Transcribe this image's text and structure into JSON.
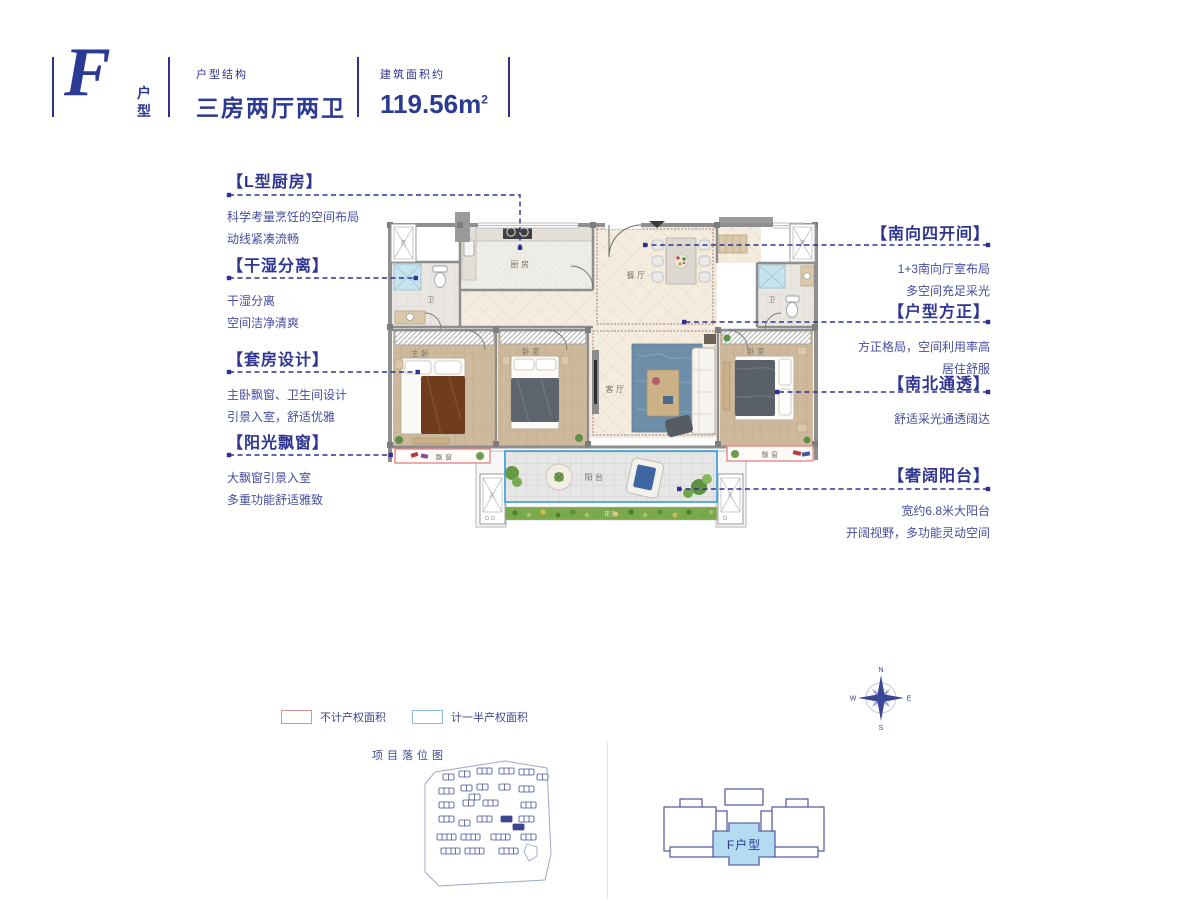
{
  "header": {
    "logo_letter": "F",
    "logo_suffix_top": "户",
    "logo_suffix_bottom": "型",
    "structure_label": "户型结构",
    "structure_value": "三房两厅两卫",
    "area_label": "建筑面积约",
    "area_value": "119.56",
    "area_unit": "m",
    "area_exp": "2"
  },
  "features_left": [
    {
      "title": "【L型厨房】",
      "lines": [
        "科学考量烹饪的空间布局",
        "动线紧凑流畅"
      ]
    },
    {
      "title": "【干湿分离】",
      "lines": [
        "干湿分离",
        "空间洁净清爽"
      ]
    },
    {
      "title": "【套房设计】",
      "lines": [
        "主卧飘窗、卫生间设计",
        "引景入室，舒适优雅"
      ]
    },
    {
      "title": "【阳光飘窗】",
      "lines": [
        "大飘窗引景入室",
        "多重功能舒适雅致"
      ]
    }
  ],
  "features_right": [
    {
      "title": "【南向四开间】",
      "lines": [
        "1+3南向厅室布局",
        "多空间充足采光"
      ]
    },
    {
      "title": "【户型方正】",
      "lines": [
        "方正格局，空间利用率高",
        "居住舒服"
      ]
    },
    {
      "title": "【南北通透】",
      "lines": [
        "舒适采光通透阔达"
      ]
    },
    {
      "title": "【奢阔阳台】",
      "lines": [
        "宽约6.8米大阳台",
        "开阔视野，多功能灵动空间"
      ]
    }
  ],
  "plan": {
    "rooms": {
      "kitchen": "厨房",
      "dining": "餐厅",
      "living": "客厅",
      "master": "主卧",
      "bedroom": "卧室",
      "bath": "卫",
      "bay_window": "飘窗",
      "balcony": "阳台",
      "flower_bed": "花池",
      "ac": "AC"
    }
  },
  "legend": [
    {
      "label": "不计产权面积",
      "color": "#df8f8f"
    },
    {
      "label": "计一半产权面积",
      "color": "#85bedd"
    }
  ],
  "site_map": {
    "title": "项目落位图"
  },
  "key_plan": {
    "label": "F户型",
    "highlight_color": "#b3dcf2"
  },
  "compass": {
    "n": "N",
    "e": "E",
    "s": "S",
    "w": "W"
  },
  "colors": {
    "accent": "#2e3192",
    "bay_border": "#e2898b",
    "balcony_border": "#45a4da"
  }
}
